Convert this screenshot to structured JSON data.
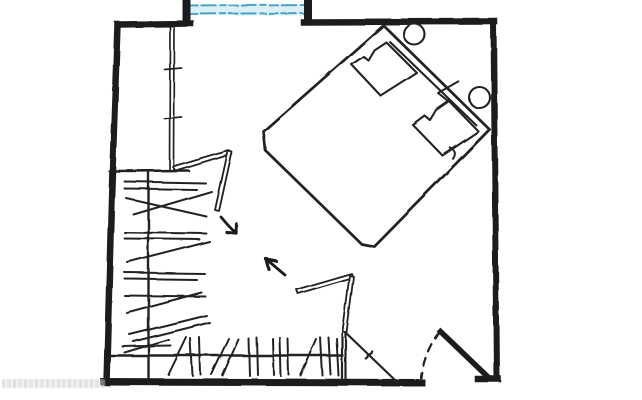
{
  "figure": {
    "kind": "hand-drawn floor plan sketch",
    "subject": "Bedroom with a 45-degree corner-angled double bed and an L-shaped walk-in closet",
    "rooms": [
      "bedroom",
      "walk-in-closet"
    ],
    "elements": [
      {
        "name": "outer-walls",
        "desc": "thick black perimeter walls"
      },
      {
        "name": "window",
        "desc": "window opening in top wall drawn with two blue glazing lines"
      },
      {
        "name": "wardrobe-partition",
        "desc": "thin double-line partition, top-left closet bay"
      },
      {
        "name": "closet-rail-left",
        "desc": "vertical hanging rail with hanger tick marks"
      },
      {
        "name": "closet-rail-bottom",
        "desc": "horizontal hanging rail with hanger tick marks"
      },
      {
        "name": "folding-door-upper",
        "desc": "open bi-fold closet door, double-line panels"
      },
      {
        "name": "folding-door-lower",
        "desc": "open bi-fold closet door with corner panel triangle"
      },
      {
        "name": "entry-door",
        "desc": "entry door leaf with dashed quarter-circle swing arc, bottom-right"
      },
      {
        "name": "bed",
        "desc": "double bed rotated diagonally into the top-right corner"
      },
      {
        "name": "headboard-shelf",
        "desc": "headboard board behind bed with two round lamps/knobs"
      },
      {
        "name": "pillows",
        "desc": "two pillows drawn with pinch squiggles"
      },
      {
        "name": "circulation-arrows",
        "desc": "two small arrows showing walking path between closet and bed"
      }
    ]
  },
  "colors": {
    "background": "#ffffff",
    "ink": "#1b1b1b",
    "thin_ink": "#242424",
    "window_glass_line": "#4aa6c2",
    "window_glass_fill": "#ddeff6",
    "watermark": "#c2c2c2"
  },
  "watermark": {
    "present": true,
    "legible": false
  }
}
